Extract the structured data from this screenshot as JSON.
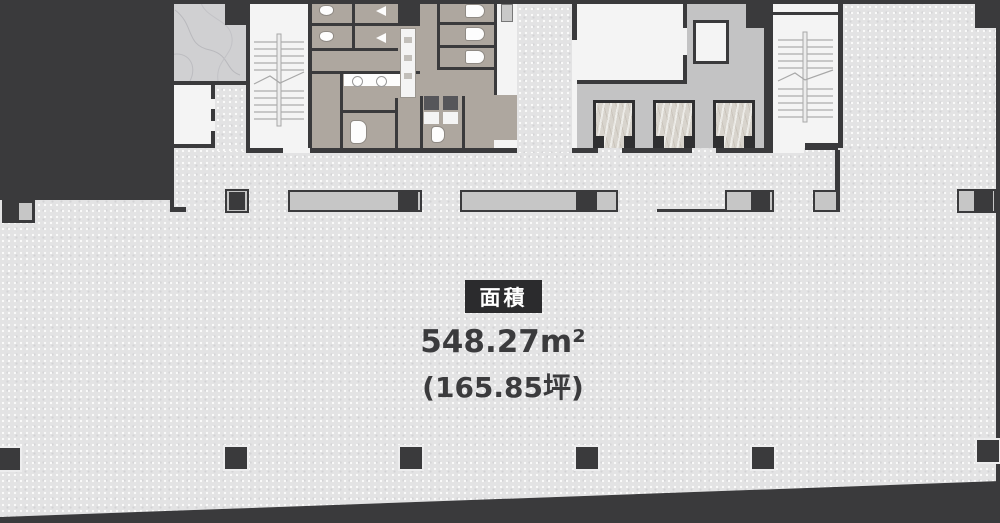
{
  "floor_plan": {
    "area_label": "面積",
    "area_sqm": "548.27m²",
    "area_tsubo": "(165.85坪)"
  },
  "colors": {
    "wall": "#3a3a3c",
    "open_floor": "#e3e3e4",
    "toilet_floor": "#aea79f",
    "elevator_lobby": "#c3c3c4",
    "marble_room": "#d0d0d2",
    "elevator_cab_marble": "#d8d4cd",
    "room_white": "#f4f4f4",
    "counter_gray": "#c6c6c6",
    "area_label_bg": "#2b2b2d",
    "area_text": "#3b3b3d"
  }
}
